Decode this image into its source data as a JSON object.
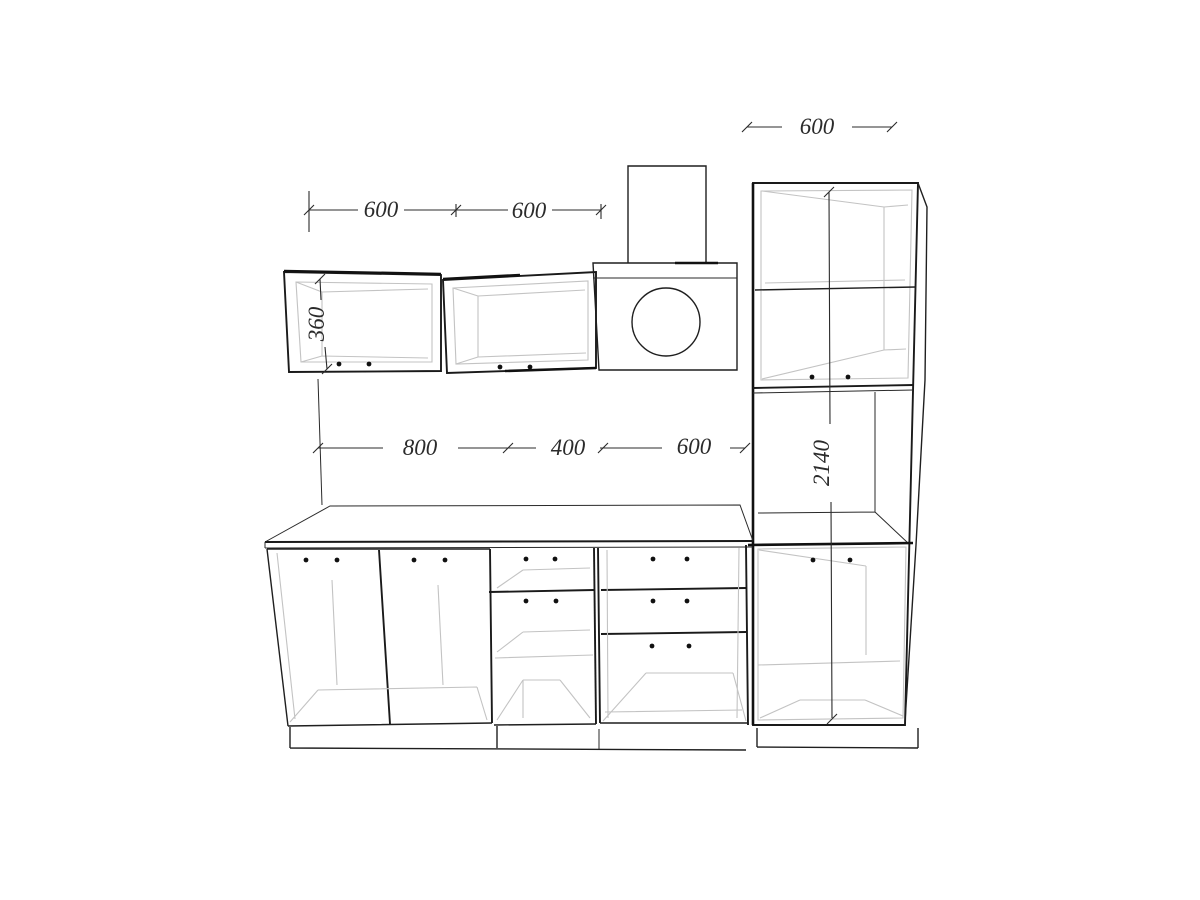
{
  "drawing": {
    "kind": "kitchen cabinetry elevation drawing",
    "dimensions": {
      "wall_cabinet_left_width": "600",
      "wall_cabinet_right_width": "600",
      "tall_cabinet_width": "600",
      "wall_cabinet_height": "360",
      "base_doors_width": "800",
      "base_open_unit_width": "400",
      "base_drawers_width": "600",
      "tall_cabinet_height": "2140"
    },
    "colors": {
      "line": "#1f1f1f",
      "interior_line": "#c3c3c3",
      "background": "#ffffff",
      "dot": "#111111",
      "dim_text": "#2b2b2b"
    }
  }
}
